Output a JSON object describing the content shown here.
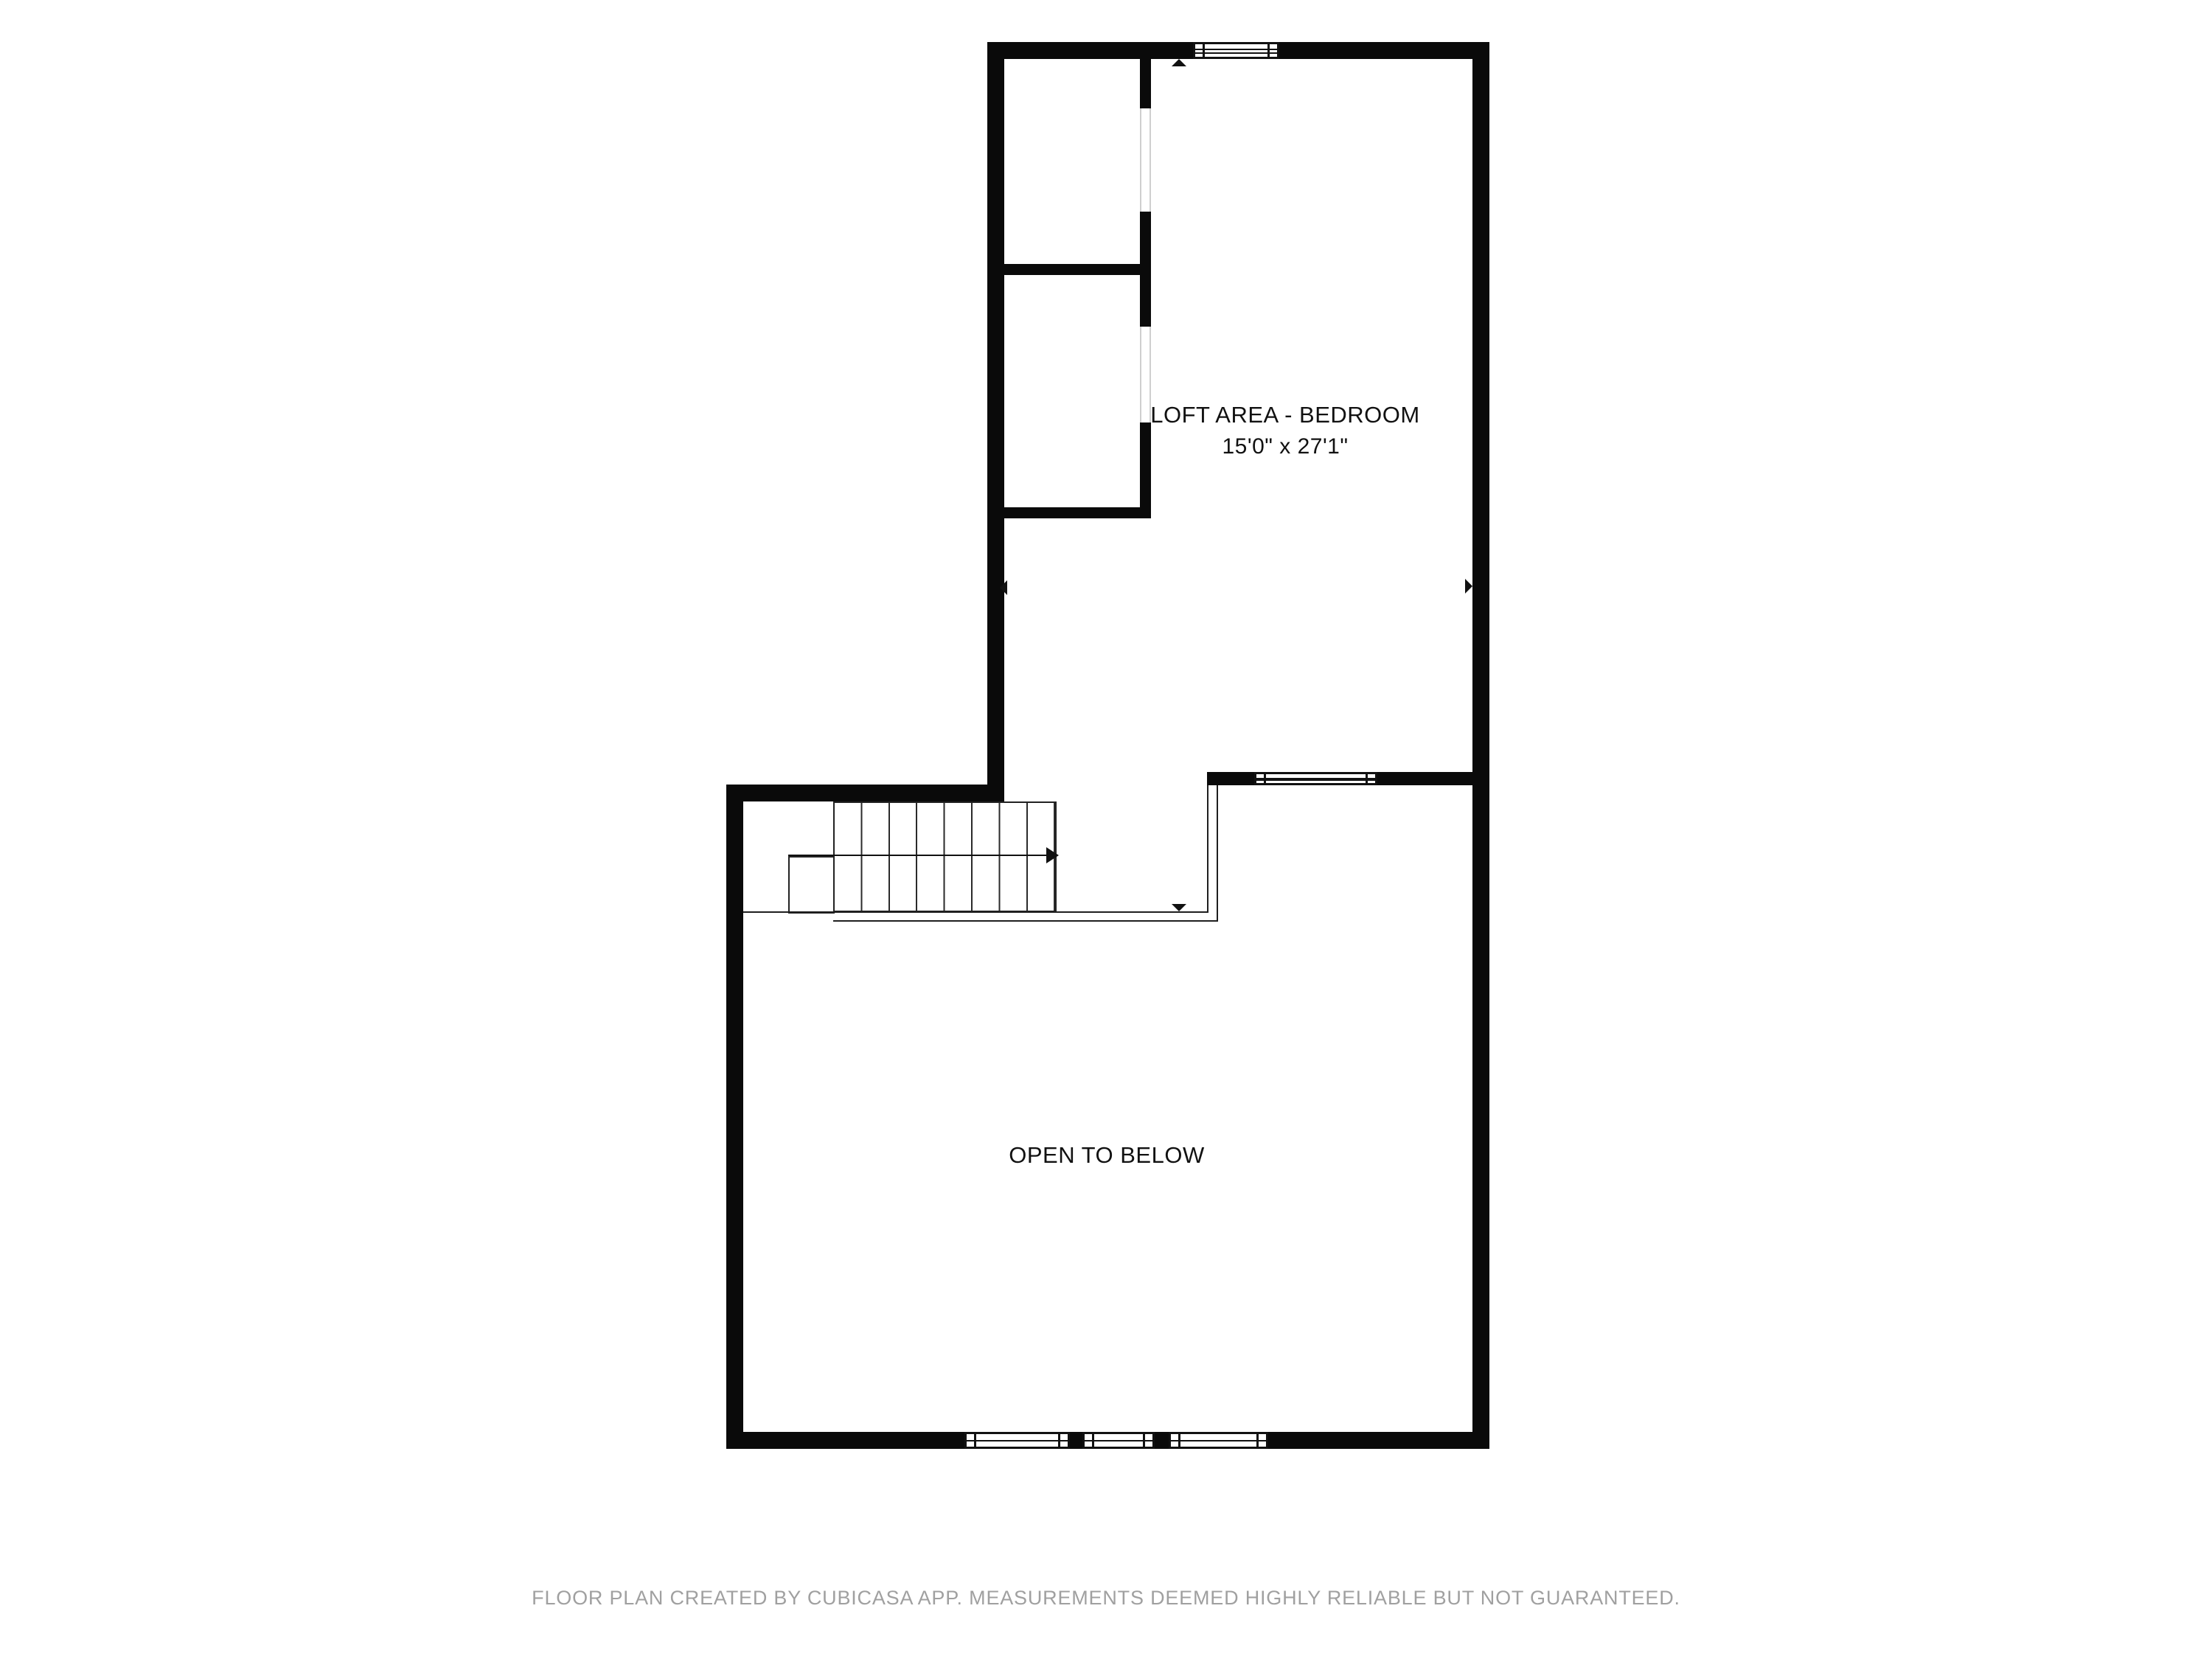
{
  "page": {
    "type": "floor-plan",
    "floor": "loft level"
  },
  "rooms": [
    {
      "name": "LOFT AREA - BEDROOM",
      "dimensions": "15'0\" x 27'1\""
    },
    {
      "name": "OPEN TO BELOW",
      "dimensions": ""
    }
  ],
  "stairs": {
    "treads": 8,
    "direction_arrow": "right",
    "down_marker": "down"
  },
  "footer": {
    "disclaimer": "FLOOR PLAN CREATED BY CUBICASA APP. MEASUREMENTS DEEMED HIGHLY RELIABLE BUT NOT GUARANTEED."
  },
  "colors": {
    "background": "#ffffff",
    "wall": "#0a0a0a",
    "thin_line": "#1f1f1f",
    "door_frame": "#cfcfcf",
    "label_text": "#111111",
    "footer_text": "#a0a0a0"
  }
}
